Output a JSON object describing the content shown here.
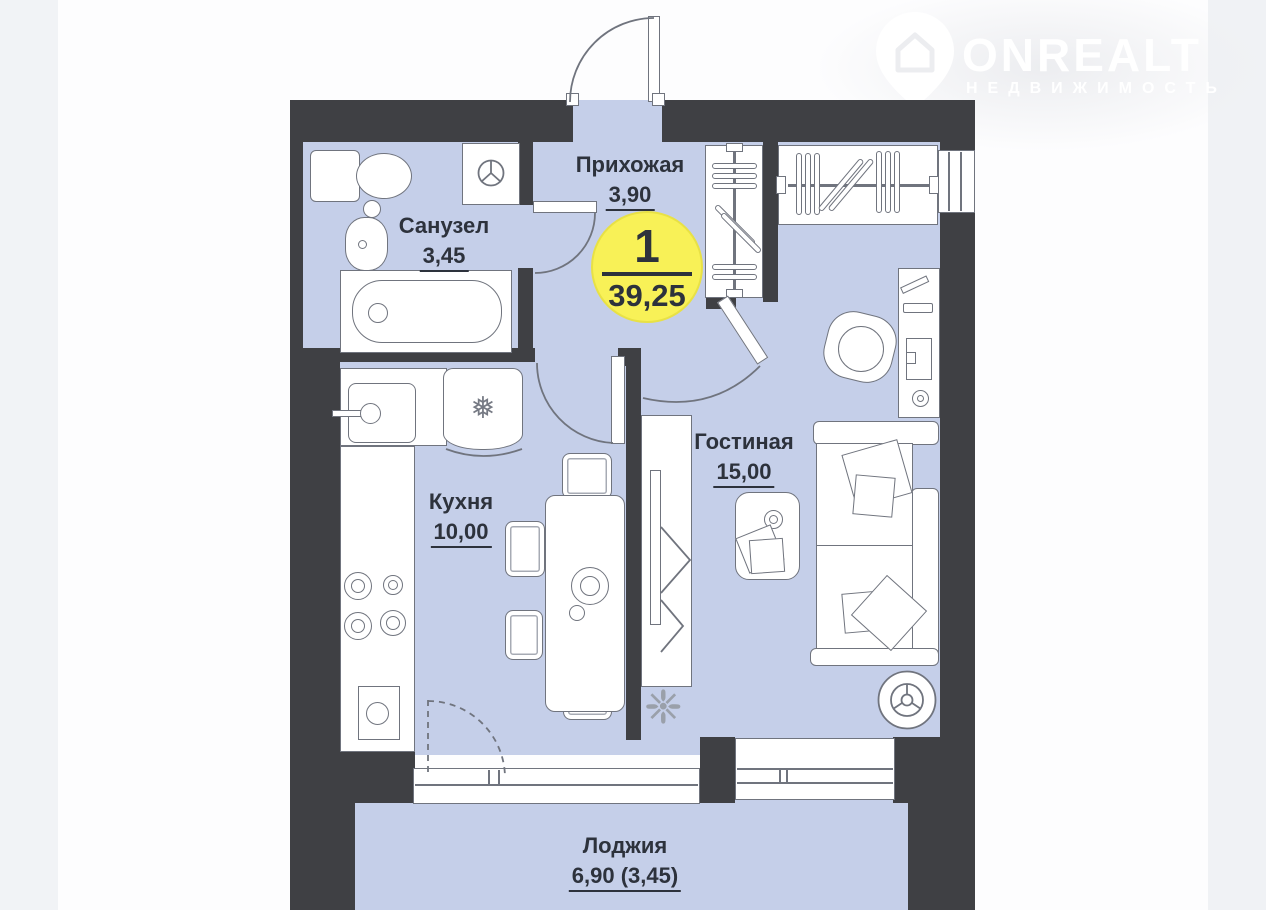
{
  "logo": {
    "name": "ONREALT",
    "subtitle": "НЕДВИЖИМОСТЬ"
  },
  "unit_badge": {
    "rooms_count": "1",
    "total_area": "39,25"
  },
  "rooms": {
    "hallway": {
      "label": "Прихожая",
      "area": "3,90"
    },
    "bathroom": {
      "label": "Санузел",
      "area": "3,45"
    },
    "kitchen": {
      "label": "Кухня",
      "area": "10,00"
    },
    "living": {
      "label": "Гостиная",
      "area": "15,00"
    },
    "loggia": {
      "label": "Лоджия",
      "area": "6,90 (3,45)"
    }
  },
  "colors": {
    "wall": "#3f4044",
    "floor": "#c5cfe9",
    "badge_fill": "#f8f157",
    "text": "#2d323c",
    "furniture_outline": "#70747e"
  }
}
